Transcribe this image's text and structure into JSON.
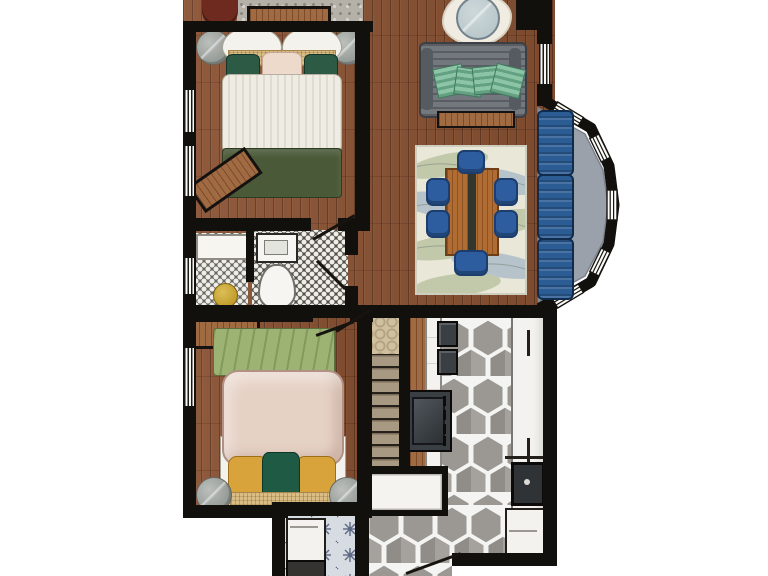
{
  "meta": {
    "type": "floor-plan-illustration",
    "view": "top-down",
    "style": "hand-rendered color rendering",
    "visible_text": "none"
  },
  "palette": {
    "wall": "#12100d",
    "wood": "#8a5233",
    "wood-light": "#a06a42",
    "stone": "#b5b1a9",
    "white-soft": "#f4f2ec",
    "linen-stroke": "#a8a296",
    "green-dark": "#2c5a45",
    "green-blanket": "#4a5a39",
    "green-bench": "#9cb374",
    "tan-woven": "#d9bd85",
    "blush": "#e6d1c5",
    "yellow": "#d9a33c",
    "gray-stand": "#8f9591",
    "sofa-gray": "#73787e",
    "pillow-mint": "#8cc4a6",
    "pillow-mint-dark": "#63a182",
    "glass": "#b9c7ca",
    "rug-cream": "#e9e7d8",
    "leaf-blue": "#8fa6bf",
    "leaf-green": "#a4b287",
    "chair-blue": "#2d5d9e",
    "chair-blue-dark": "#1c3e6e",
    "couch-blue": "#2c5c94",
    "seat-gray": "#9aa1ab",
    "tile-dark": "#514f48",
    "tile-mid": "#6b6963",
    "tile-dot": "#efeee8",
    "gold": "#c09a2a",
    "hex-gray": "#9b9894",
    "grout": "#f4f4f2",
    "counter-white": "#f3f2ee",
    "appliance-dark": "#3a3f44",
    "stair-tread": "#a89a82",
    "trellis-bg": "#cfc0a0",
    "trellis-line": "#b3a182",
    "laundry-bg": "#d7dbe2",
    "laundry-star": "#5d6b84",
    "red-chair": "#6e2a1e"
  },
  "rooms": [
    {
      "name": "bedroom-1",
      "position": "top-left",
      "floor": "hardwood",
      "furniture": [
        "double-bed-white-striped-duvet",
        "two-white-pillows",
        "tan-woven-bolster",
        "two-dark-green-pillows",
        "blush-pillow",
        "dark-green-foot-blanket",
        "round-nightstand-left",
        "round-nightstand-right",
        "angled-wood-bench",
        "wood-console-against-top-wall"
      ],
      "windows": 2
    },
    {
      "name": "bathroom",
      "position": "mid-left",
      "floor": "penny-tile",
      "furniture": [
        "white-vanity-counter",
        "rectangular-sink",
        "toilet",
        "gold-stool"
      ],
      "windows": 1,
      "doors": 1
    },
    {
      "name": "bedroom-2",
      "position": "bottom-left",
      "floor": "hardwood",
      "furniture": [
        "double-bed-blush-duvet",
        "two-mustard-pillows",
        "dark-green-center-pillow",
        "tan-woven-bolster",
        "green-textured-bench",
        "wood-dresser",
        "round-nightstand-left",
        "round-nightstand-right"
      ],
      "windows": 1,
      "doors": 1
    },
    {
      "name": "living-room",
      "position": "top-right",
      "floor": "hardwood",
      "furniture": [
        "gray-striped-sofa",
        "four-mint-patterned-throw-pillows",
        "wood-console-behind-sofa",
        "round-glass-side-table",
        "white-shag-rug",
        "stone-hearth-strip",
        "dark-red-armchair-partial"
      ],
      "windows": 1
    },
    {
      "name": "dining-area",
      "position": "center-right",
      "floor": "hardwood",
      "furniture": [
        "leaf-pattern-area-rug",
        "wood-dining-table-dark-runner",
        "six-blue-chairs"
      ]
    },
    {
      "name": "bay-window",
      "position": "right",
      "furniture": [
        "gray-window-seat",
        "three-blue-cushions"
      ],
      "windows": 5
    },
    {
      "name": "kitchen",
      "position": "bottom-right",
      "floor": "gray-hexagon-tile",
      "furniture": [
        "left-wood-cabinet-run",
        "range-stove",
        "two-dark-counter-fixtures",
        "right-white-counter-run",
        "dark-sink",
        "dishwasher"
      ],
      "doors": 1
    },
    {
      "name": "stairs",
      "position": "center-bottom",
      "furniture": [
        "trellis-runner-rug",
        "wood-treads",
        "white-landing"
      ]
    },
    {
      "name": "laundry-mudroom",
      "position": "bottom-center",
      "floor": "blue-starburst-tile",
      "furniture": [
        "washer-white",
        "dryer-dark-partial"
      ],
      "doors": 1
    }
  ],
  "counts": {
    "dining_chairs": 6,
    "bay_cushions": 3,
    "sofa_pillows": 4,
    "nightstands": 4
  }
}
